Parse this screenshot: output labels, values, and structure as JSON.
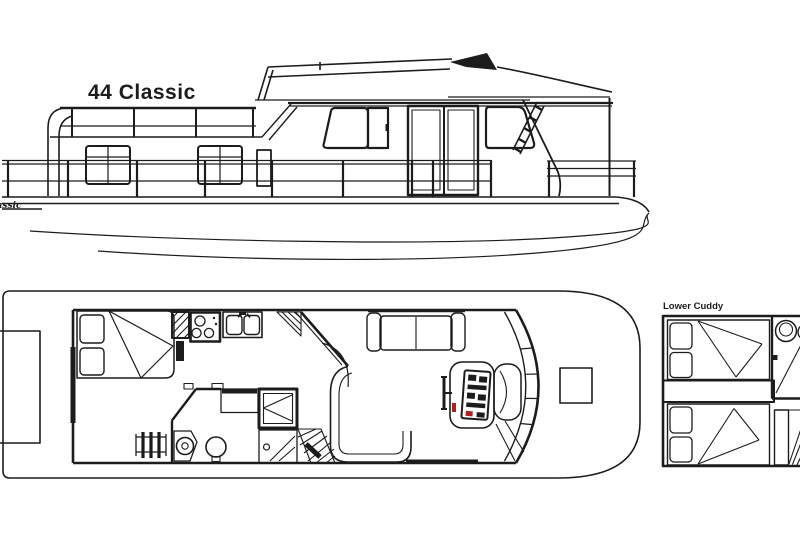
{
  "image": {
    "background_color": "#ffffff",
    "line_color": "#1c1c1c",
    "accent_red": "#b02020"
  },
  "side_view": {
    "title": "44 Classic",
    "hull_logo_text": "Classic",
    "features": [
      "flybridge-railing",
      "canopy-hardtop",
      "venturi-windshield",
      "aft-cabin-windows",
      "pilothouse-window",
      "sliding-glass-door",
      "bow-windshield",
      "flybridge-ladder",
      "bow-railing",
      "hull"
    ]
  },
  "main_deck_plan": {
    "fixtures": [
      "swim-platform",
      "double-bed",
      "wardrobe",
      "stove",
      "double-sink",
      "counter-corner",
      "ladder",
      "vanity-sink",
      "toilet",
      "shower",
      "stairs-to-cuddy",
      "dinette-bench",
      "sofa",
      "helm-console",
      "steering-wheel",
      "captain-seat",
      "bow-windshield",
      "bow-step"
    ]
  },
  "lower_cuddy_plan": {
    "label": "Lower Cuddy",
    "fixtures": [
      "upper-berth",
      "lower-berth",
      "toilet",
      "wash-basin",
      "landing",
      "stairs"
    ]
  }
}
